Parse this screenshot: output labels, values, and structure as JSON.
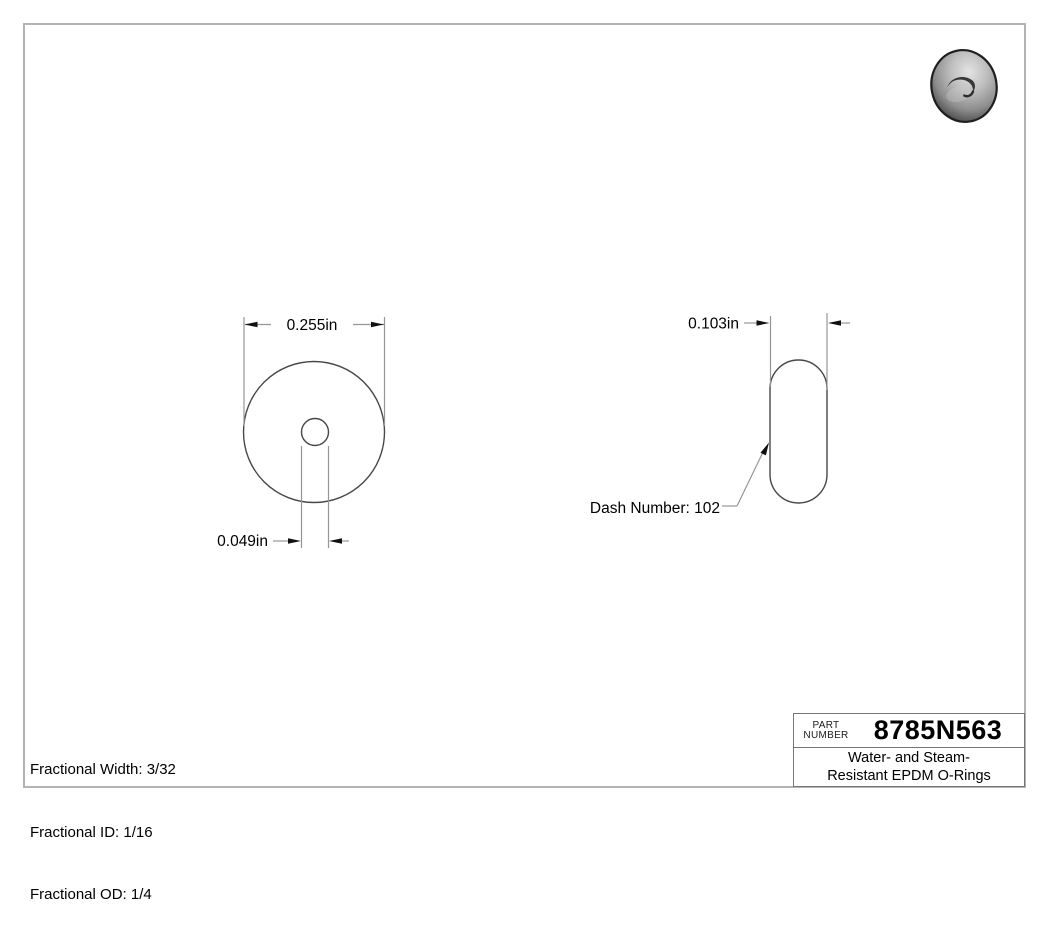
{
  "page": {
    "background": "#ffffff",
    "border_color": "#b3b3b3"
  },
  "views": {
    "front": {
      "od_dimension": "0.255in",
      "id_dimension": "0.049in"
    },
    "side": {
      "cross_section_width_dimension": "0.103in",
      "dash_number_label": "Dash Number: 102"
    }
  },
  "notes": [
    "Fractional Width: 3/32",
    "Fractional ID: 1/16",
    "Fractional OD: 1/4"
  ],
  "title_block": {
    "part_label": [
      "PART",
      "NUMBER"
    ],
    "part_number": "8785N563",
    "description": [
      "Water- and Steam-",
      "Resistant EPDM O-Rings"
    ]
  },
  "colors": {
    "object_line": "#474747",
    "dimension_line": "#969696",
    "arrowhead": "#111111",
    "text": "#000000"
  }
}
